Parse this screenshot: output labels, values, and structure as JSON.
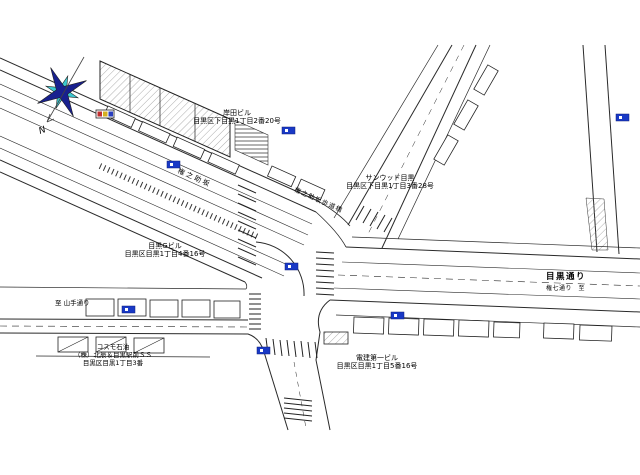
{
  "colors": {
    "marker_blue": "#1939c6",
    "signal_red": "#c03030",
    "signal_yellow": "#d4b020",
    "signal_green": "#2a3fbf",
    "compass_primary": "#18208f",
    "compass_secondary": "#3cc8d0"
  },
  "compass": {
    "north_label": "N"
  },
  "buildings": [
    {
      "name": "岸田ビル",
      "address": "目黒区下目黒1丁目2番20号"
    },
    {
      "name": "サンウッド目黒",
      "address": "目黒区下目黒1丁目3番28号"
    },
    {
      "name": "目黒Gビル",
      "address": "目黒区目黒1丁目4番16号"
    },
    {
      "name": "コスモ石油",
      "operator": "（株）北辰＆目黒駅前ＳＳ",
      "address": "目黒区目黒1丁目3番"
    },
    {
      "name": "電建第一ビル",
      "address": "目黒区目黒1丁目5番16号"
    }
  ],
  "roads": {
    "meguro_dori": "目黒通り",
    "meguro_dori_sub": "権七通り　至",
    "to_west": "至 山手通り",
    "gonnosuke_slope": "権之助坂",
    "footbridge": "権之助坂歩道橋"
  }
}
